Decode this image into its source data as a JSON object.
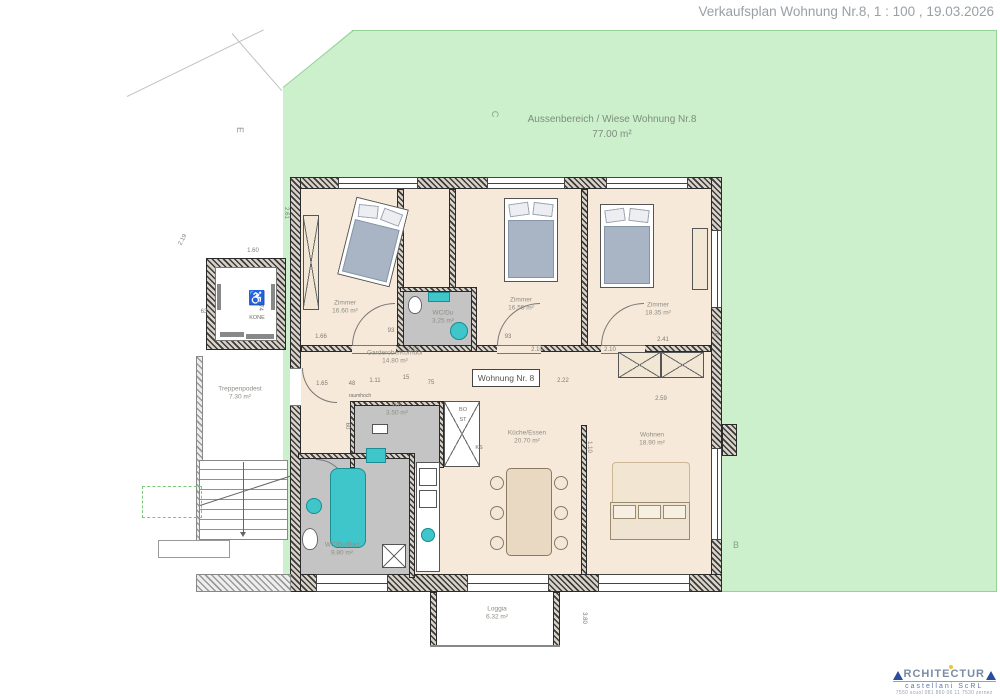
{
  "title": "Verkaufsplan Wohnung Nr.8, 1 : 100 , 19.03.2026",
  "outdoor": {
    "line1": "Aussenbereich / Wiese Wohnung Nr.8",
    "line2": "77.00 m²"
  },
  "apartment_label": "Wohnung Nr. 8",
  "rooms": [
    {
      "name": "Zimmer",
      "area": "16.60 m²",
      "x": 345,
      "y": 308
    },
    {
      "name": "Zimmer",
      "area": "16.55 m²",
      "x": 521,
      "y": 305
    },
    {
      "name": "Zimmer",
      "area": "18.35 m²",
      "x": 658,
      "y": 310
    },
    {
      "name": "WC/Du",
      "area": "3.25 m²",
      "x": 443,
      "y": 318
    },
    {
      "name": "Garderobe/Korridor",
      "area": "14.80 m²",
      "x": 395,
      "y": 358
    },
    {
      "name": "WK",
      "area": "3.50 m²",
      "x": 397,
      "y": 410
    },
    {
      "name": "Küche/Essen",
      "area": "20.70 m²",
      "x": 527,
      "y": 438
    },
    {
      "name": "Wohnen",
      "area": "18.90 m²",
      "x": 652,
      "y": 440
    },
    {
      "name": "WC/Du/Bad",
      "area": "9.80 m²",
      "x": 342,
      "y": 550
    },
    {
      "name": "Treppenpodest",
      "area": "7.30 m²",
      "x": 240,
      "y": 394
    },
    {
      "name": "Loggia",
      "area": "6.32 m²",
      "x": 497,
      "y": 614
    }
  ],
  "markers": [
    {
      "id": "C",
      "x": 495,
      "y": 114,
      "r": 90
    },
    {
      "id": "B",
      "x": 736,
      "y": 545,
      "r": 0
    },
    {
      "id": "E",
      "x": 240,
      "y": 130,
      "r": 90
    }
  ],
  "small_labels": [
    {
      "t": "KONE",
      "x": 257,
      "y": 318,
      "s": 5.5
    },
    {
      "t": "♿",
      "x": 257,
      "y": 298,
      "s": 14
    },
    {
      "t": "raumhoch",
      "x": 360,
      "y": 396,
      "s": 5
    },
    {
      "t": "BO",
      "x": 463,
      "y": 410,
      "s": 5.5
    },
    {
      "t": "ST",
      "x": 463,
      "y": 420,
      "s": 5.5
    },
    {
      "t": "KS",
      "x": 479,
      "y": 448,
      "s": 5.5
    }
  ],
  "dimensions": [
    {
      "t": "1.66",
      "x": 321,
      "y": 337,
      "r": 0
    },
    {
      "t": "93",
      "x": 391,
      "y": 331,
      "r": 0
    },
    {
      "t": "2.10",
      "x": 413,
      "y": 350,
      "r": 0
    },
    {
      "t": "93",
      "x": 508,
      "y": 337,
      "r": 0
    },
    {
      "t": "2.10",
      "x": 537,
      "y": 350,
      "r": 0
    },
    {
      "t": "2.10",
      "x": 610,
      "y": 350,
      "r": 0
    },
    {
      "t": "2.41",
      "x": 663,
      "y": 340,
      "r": 0
    },
    {
      "t": "1.65",
      "x": 322,
      "y": 384,
      "r": 0
    },
    {
      "t": "48",
      "x": 352,
      "y": 384,
      "r": 0
    },
    {
      "t": "1.11",
      "x": 375,
      "y": 381,
      "r": 0
    },
    {
      "t": "15",
      "x": 406,
      "y": 378,
      "r": 0
    },
    {
      "t": "75",
      "x": 431,
      "y": 383,
      "r": 0
    },
    {
      "t": "90",
      "x": 500,
      "y": 384,
      "r": 0
    },
    {
      "t": "2.22",
      "x": 563,
      "y": 381,
      "r": 0
    },
    {
      "t": "2.59",
      "x": 661,
      "y": 399,
      "r": 0
    },
    {
      "t": "60",
      "x": 347,
      "y": 426,
      "r": 90
    },
    {
      "t": "2.61",
      "x": 286,
      "y": 213,
      "r": 90
    },
    {
      "t": "2.19",
      "x": 183,
      "y": 240,
      "r": -62
    },
    {
      "t": "1.60",
      "x": 253,
      "y": 251,
      "r": 0
    },
    {
      "t": "63",
      "x": 204,
      "y": 312,
      "r": 0
    },
    {
      "t": "1.74",
      "x": 260,
      "y": 305,
      "r": 90
    },
    {
      "t": "76",
      "x": 715,
      "y": 333,
      "r": 90
    },
    {
      "t": "1.10",
      "x": 589,
      "y": 447,
      "r": 90
    },
    {
      "t": "3.80",
      "x": 584,
      "y": 618,
      "r": 90
    }
  ],
  "logo": {
    "word": "RCHITECTUR",
    "line2": "castellani ScRL",
    "line3": "7550 scuol  081 860 06 11  7530 zernez"
  },
  "colors": {
    "site_green": "#cdf0cc",
    "floor_beige": "#f7e9d9",
    "wet_gray": "#c4c4c4",
    "fixture_teal": "#3fc6cb",
    "wall_dark": "#3a3a3a",
    "logo_blue": "#2b4da0",
    "logo_yellow": "#f2c230",
    "title_gray": "#9aa0a4"
  }
}
